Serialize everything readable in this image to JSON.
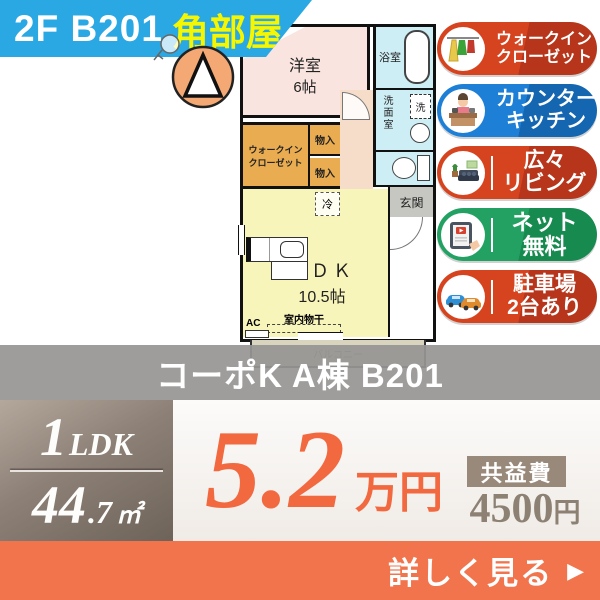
{
  "header": {
    "floor_unit": "2F  B201",
    "corner_label": "角部屋"
  },
  "floor_plan": {
    "rooms": {
      "western": {
        "name": "洋室",
        "size": "6帖"
      },
      "bath": {
        "name": "浴室"
      },
      "washroom": {
        "name": "洗面室"
      },
      "washer": {
        "name": "洗"
      },
      "entrance": {
        "name": "玄関"
      },
      "wic": {
        "line1": "ウォークイン",
        "line2": "クローゼット"
      },
      "storage_upper": {
        "name": "物入"
      },
      "storage_lower": {
        "name": "物入"
      },
      "fridge": {
        "name": "冷"
      },
      "ldk": {
        "name": "ＬＤＫ",
        "size": "10.5帖"
      },
      "drying": {
        "name": "室内物干"
      },
      "ac": {
        "name": "AC"
      },
      "balcony": {
        "name": "バルコニー"
      }
    }
  },
  "badges": [
    {
      "icon": "walk-in-closet-icon",
      "line1": "ウォークイン",
      "line2": "クローゼット",
      "color": "#d6431f"
    },
    {
      "icon": "counter-kitchen-icon",
      "line1": "カウンター",
      "line2": "キッチン",
      "color": "#1d7fd6"
    },
    {
      "icon": "spacious-living-icon",
      "line1": "広々",
      "line2": "リビング",
      "color": "#d6431f"
    },
    {
      "icon": "free-internet-icon",
      "line1": "ネット",
      "line2": "無料",
      "color": "#22a163"
    },
    {
      "icon": "parking-icon",
      "line1": "駐車場",
      "line2": "2台あり",
      "color": "#d6431f"
    }
  ],
  "title_bar": {
    "title": "コーポK A棟 B201"
  },
  "summary": {
    "layout": {
      "count": "1",
      "type": "LDK"
    },
    "area": {
      "int": "44",
      "dec": ".7",
      "unit": "㎡"
    },
    "rent": {
      "value": "5.2",
      "unit": "万円"
    },
    "fee": {
      "label": "共益費",
      "value": "4500",
      "unit": "円"
    }
  },
  "cta": {
    "label": "詳しく見る",
    "arrow": "▶"
  },
  "colors": {
    "header_bg": "#29a8e3",
    "header_corner_text": "#f6f600",
    "badge_red": "#d6431f",
    "badge_blue": "#1d7fd6",
    "badge_green": "#22a163",
    "rent_accent": "#f2683f",
    "cta_bg": "#f2744c",
    "title_bar_bg": "#979693",
    "spec_box_bg": "#8d8177",
    "fee_label_bg": "#99897b"
  }
}
